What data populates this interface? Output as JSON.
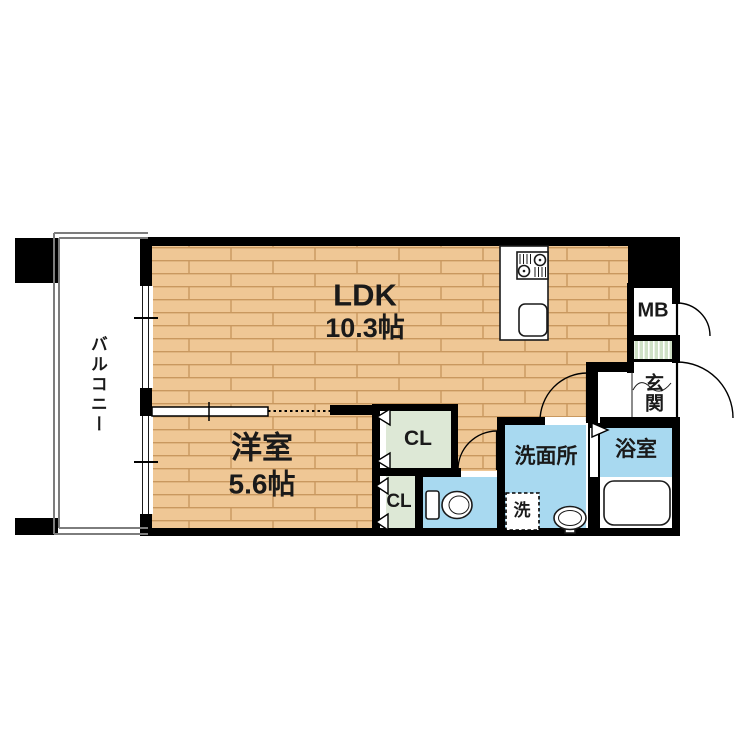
{
  "floorplan": {
    "rooms": {
      "ldk": {
        "name": "LDK",
        "size": "10.3帖"
      },
      "bedroom": {
        "name": "洋室",
        "size": "5.6帖"
      },
      "balcony": {
        "name": "バルコニー"
      },
      "washroom": {
        "name": "洗面所"
      },
      "bathroom": {
        "name": "浴室"
      },
      "entrance": {
        "name": "玄関"
      },
      "meter_box": {
        "name": "MB"
      },
      "closet_upper": {
        "name": "CL"
      },
      "closet_lower": {
        "name": "CL"
      },
      "laundry": {
        "name": "洗"
      }
    },
    "colors": {
      "wood_floor": "#efc795",
      "wet_area_blue": "#a8d9f0",
      "closet_green": "#dde8d6",
      "wall_black": "#000000"
    }
  }
}
